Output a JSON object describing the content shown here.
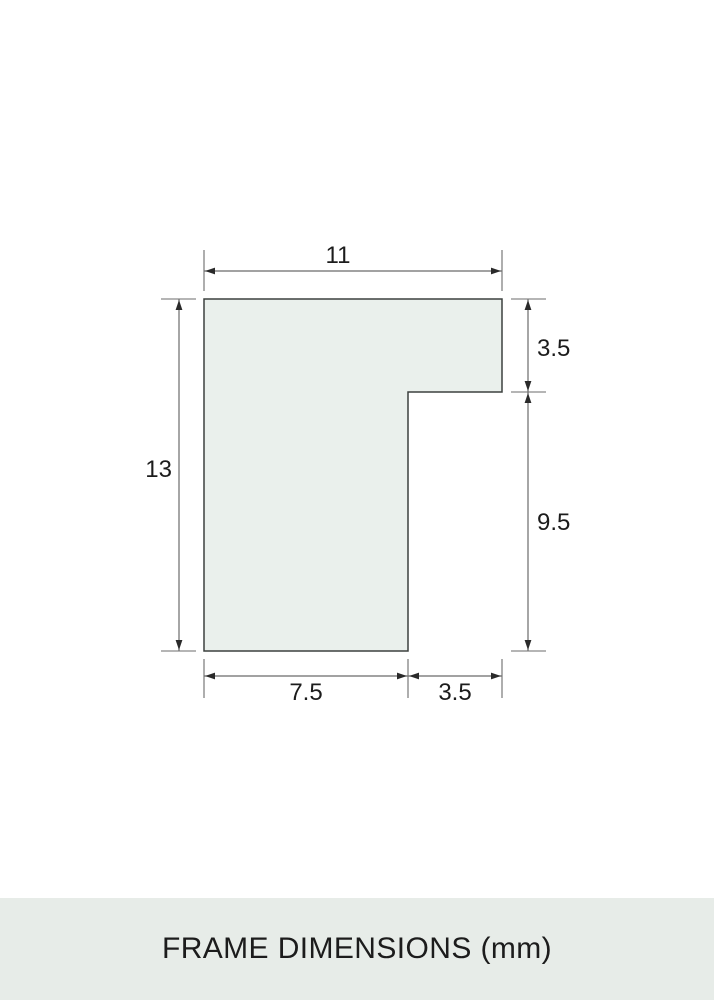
{
  "caption": {
    "text": "FRAME DIMENSIONS (mm)"
  },
  "diagram": {
    "dimensions": {
      "top_width": "11",
      "left_height": "13",
      "right_upper": "3.5",
      "right_lower": "9.5",
      "bottom_left": "7.5",
      "bottom_right": "3.5"
    }
  },
  "colors": {
    "shape_fill": "#eaf0ec",
    "shape_outline": "#3c403e",
    "dimension_line": "#6b6b6b",
    "arrow": "#2a2a2a",
    "text": "#1c1c1c",
    "band_bg": "#e7ece8",
    "page_bg": "#ffffff"
  }
}
